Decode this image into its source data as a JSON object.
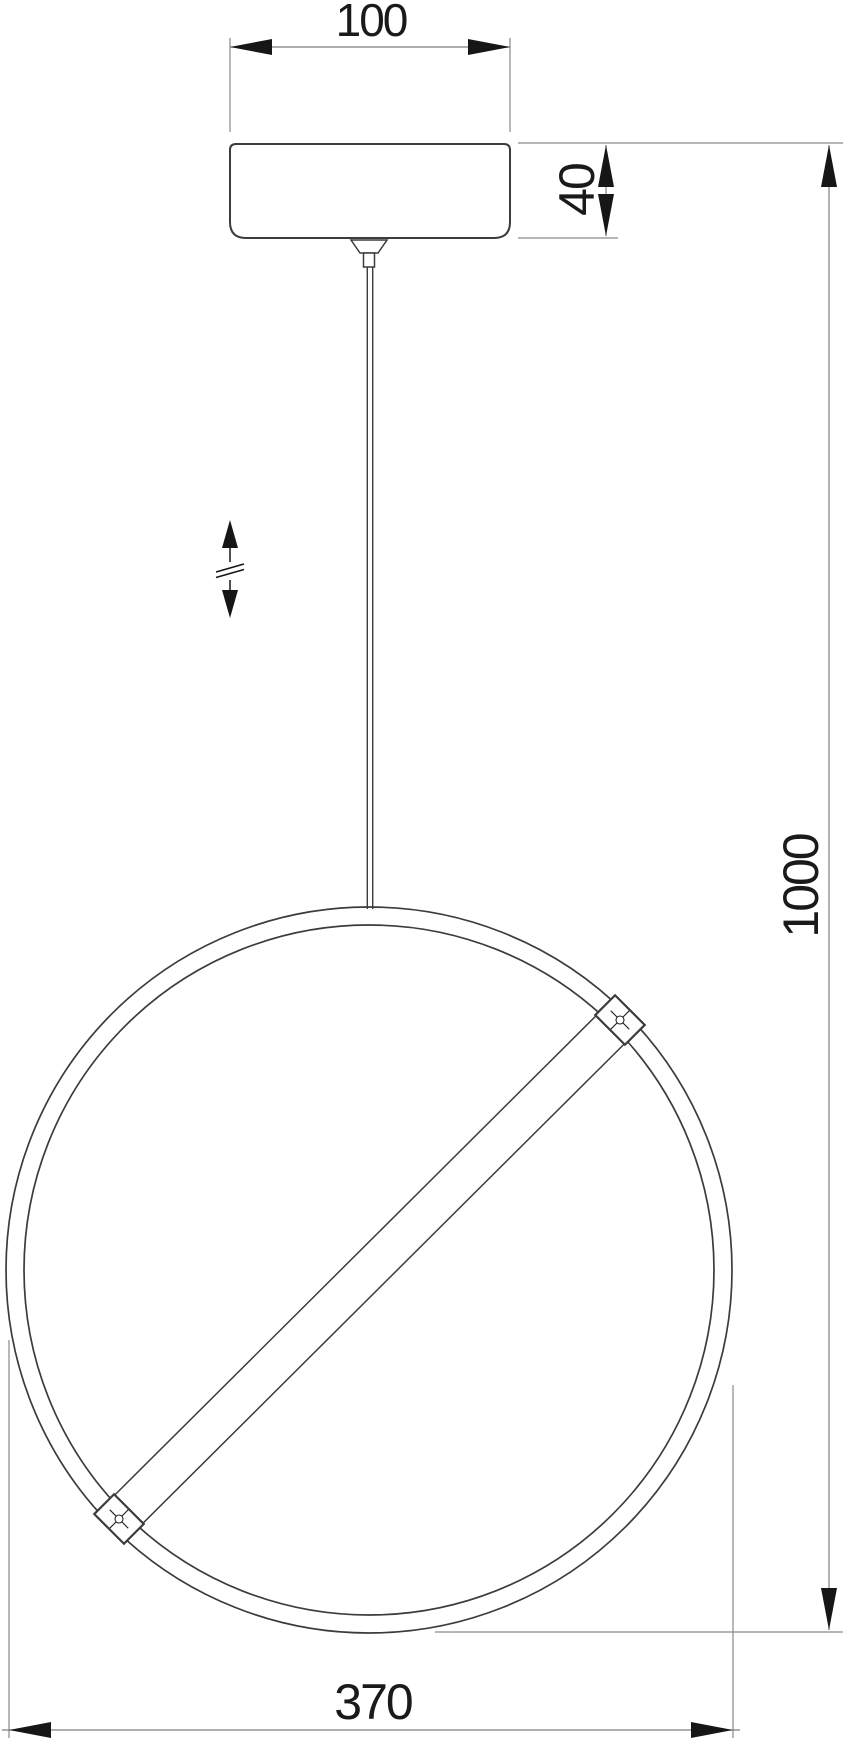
{
  "page": {
    "kind": "technical-dimension-drawing",
    "subject": "pendant-ring-lamp-front-view",
    "background": "#ffffff",
    "width_px": 848,
    "height_px": 1744
  },
  "colors": {
    "object_line": "#3c3c3c",
    "dimension_line": "#7e7e7e",
    "arrow_and_text": "#161616"
  },
  "dimensions": {
    "canopy_width": {
      "label": "100",
      "orientation": "horizontal"
    },
    "canopy_height": {
      "label": "40",
      "orientation": "vertical-rotated"
    },
    "overall_height": {
      "label": "1000",
      "orientation": "vertical-rotated"
    },
    "ring_width": {
      "label": "370",
      "orientation": "horizontal"
    }
  },
  "symbols": {
    "height_adjustable": "double-vertical-arrow-with-break-marks"
  }
}
